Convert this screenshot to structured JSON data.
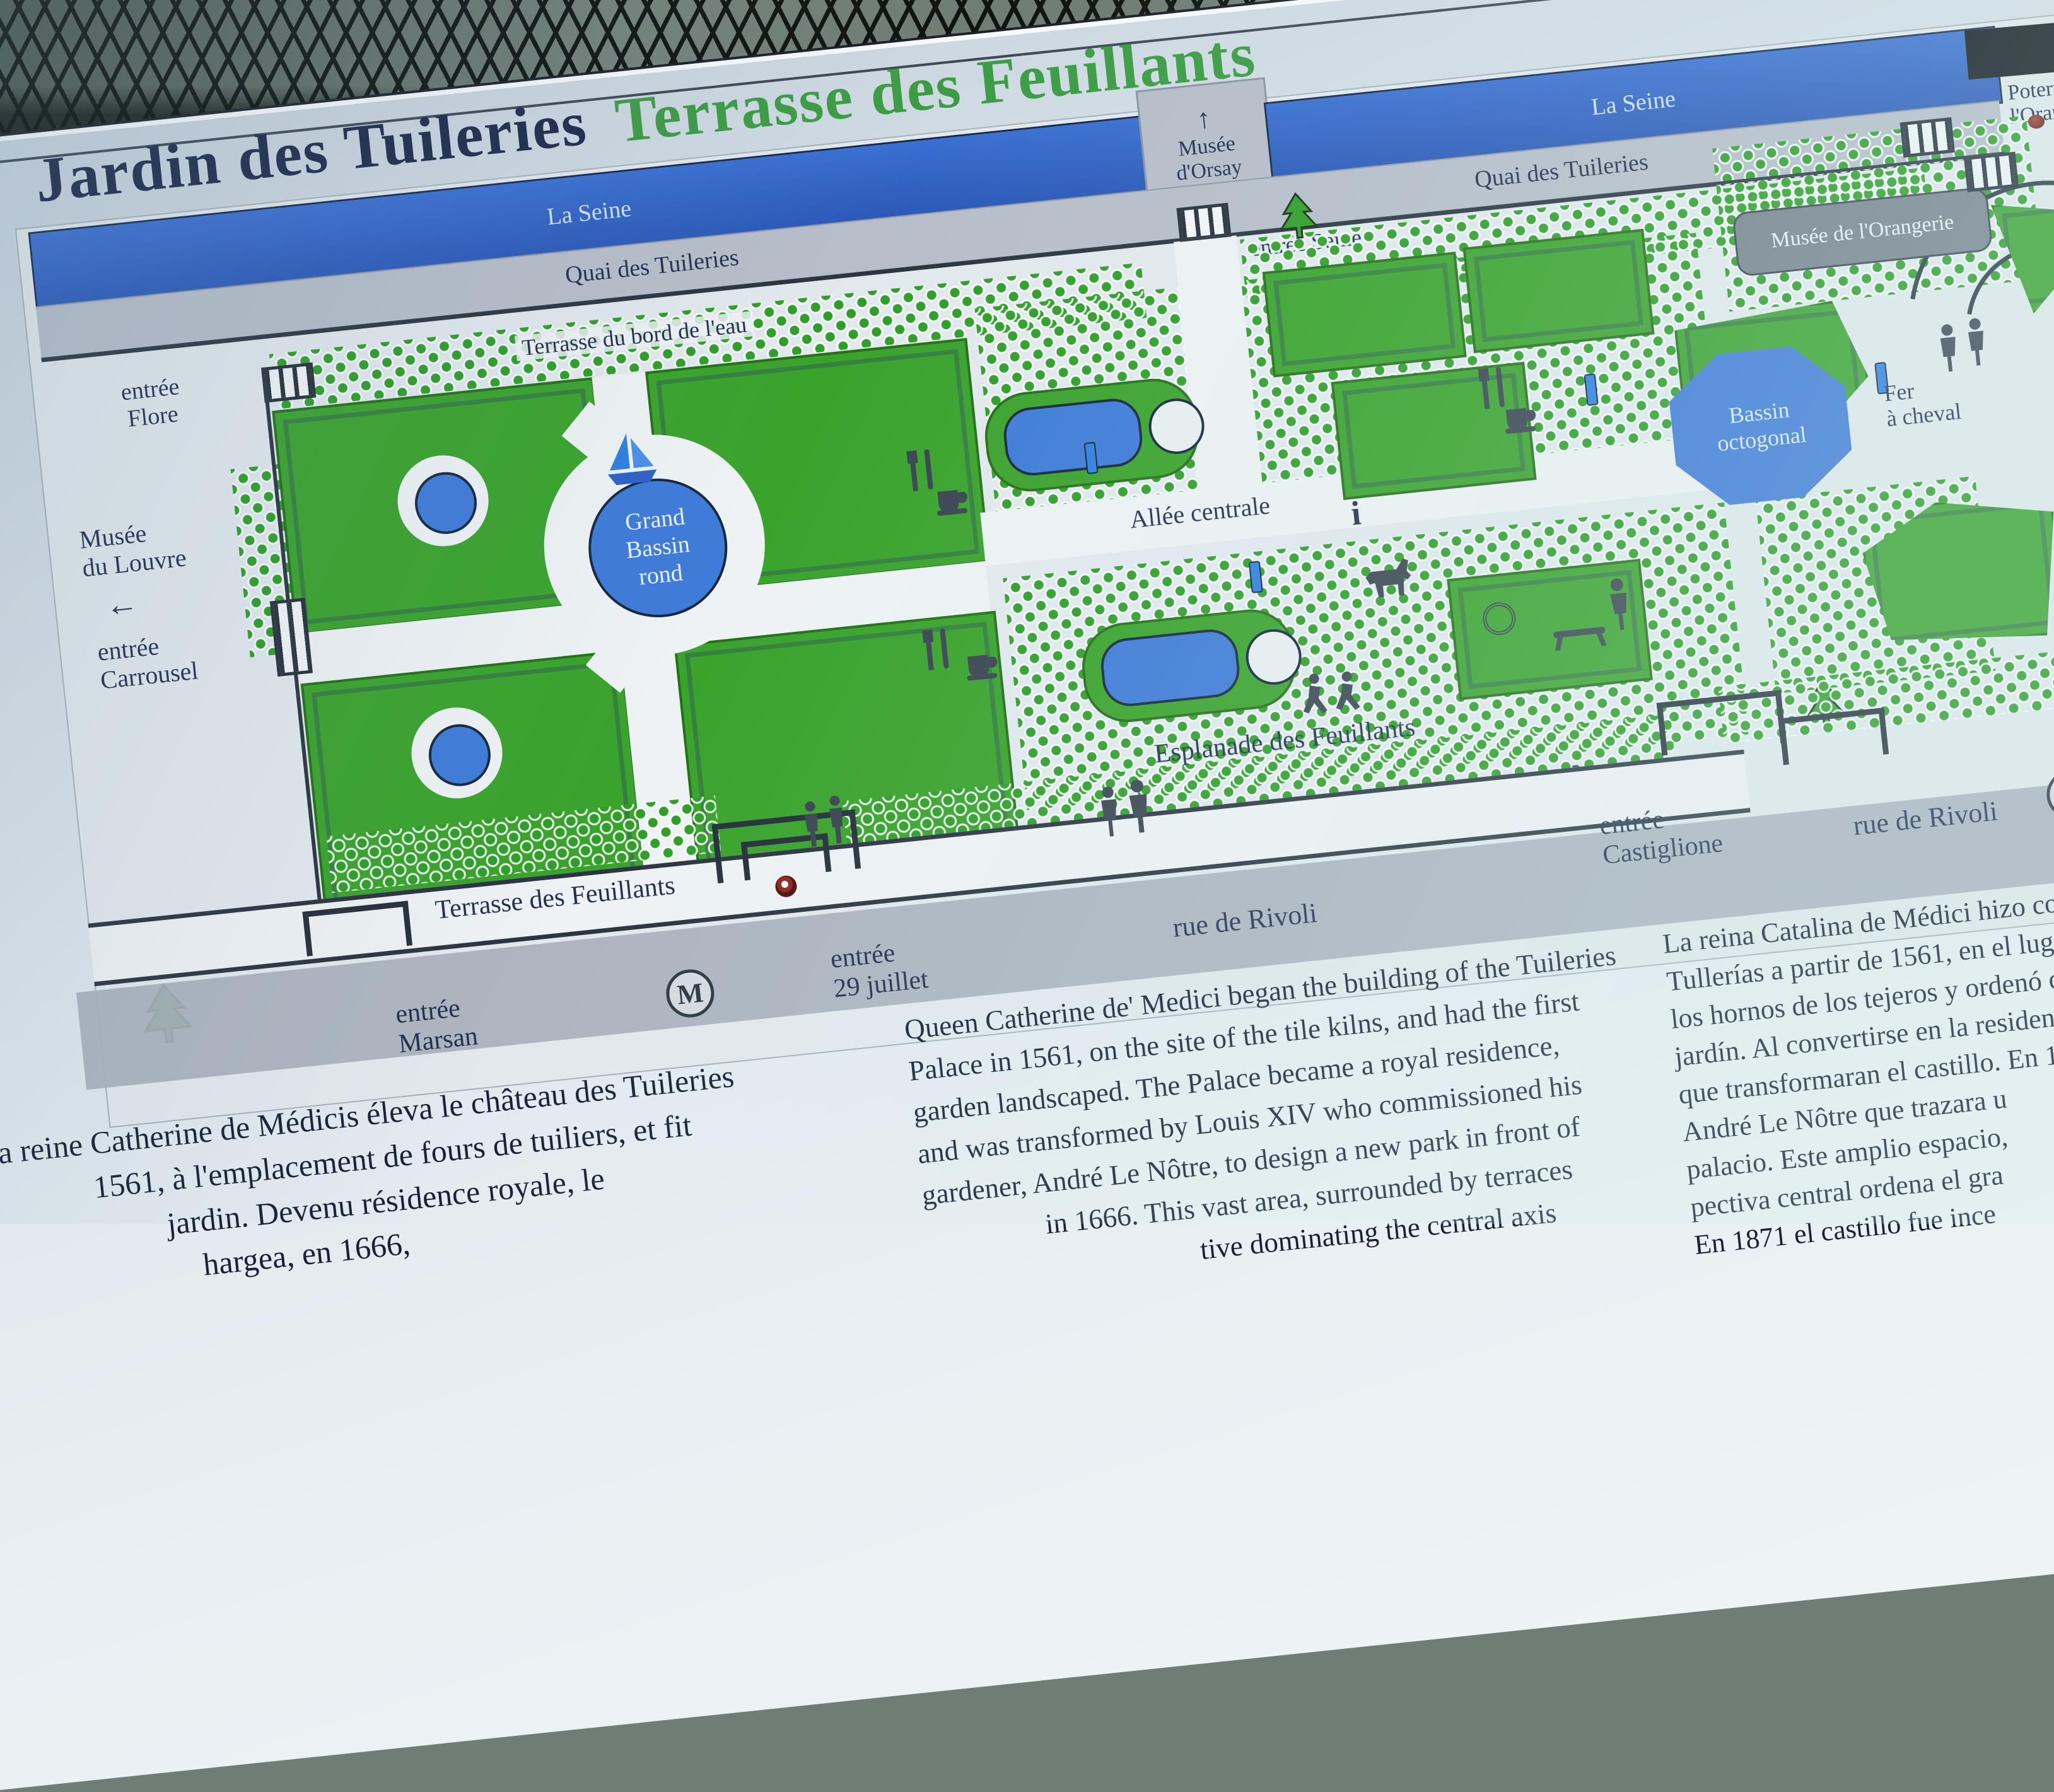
{
  "sign": {
    "title": "Jardin des Tuileries",
    "subtitle": "Terrasse des Feuillants",
    "seine_left": "La Seine",
    "seine_right": "La Seine",
    "quai_left": "Quai des Tuileries",
    "quai_right": "Quai des Tuileries",
    "orsay_arrow": "↑",
    "orsay": "Musée\nd'Orsay",
    "entree_seine": "entrée Seine",
    "entree_poterne": "entrée\nPoterne de\nl'Orangerie",
    "entree_flore": "entrée\nFlore",
    "musee_louvre": "Musée\ndu Louvre",
    "louvre_arrow": "←",
    "entree_carrousel": "entrée\nCarrousel",
    "entree_marsan": "entrée\nMarsan",
    "entree_29juillet": "entrée\n29 juillet",
    "entree_castiglione": "entrée\nCastiglione",
    "terrasse_bord_eau": "Terrasse du bord de l'eau",
    "allee_centrale": "Allée centrale",
    "esplanade": "Esplanade des Feuillants",
    "terrasse_feuillants": "Terrasse des Feuillants",
    "rue_rivoli_left": "rue de Rivoli",
    "rue_rivoli_right": "rue de Rivoli",
    "grand_bassin": "Grand\nBassin\nrond",
    "bassin_octogonal": "Bassin\noctogonal",
    "fer_a_cheval": "Fer\nà cheval",
    "musee_orangerie": "Musée de l'Orangerie",
    "terrasse_orangerie": "Terrasse de l'Orangerie",
    "metro": "M",
    "metro_right": "M",
    "info_i": "i",
    "paragraphs": {
      "french": [
        "a reine Catherine de Médicis éleva le château des Tuileries",
        "1561, à l'emplacement de fours de tuiliers, et fit",
        "jardin. Devenu résidence royale, le",
        "hargea, en 1666,"
      ],
      "english": [
        "Queen Catherine de' Medici began the building of the Tuileries",
        "Palace in 1561, on the site of the tile kilns, and had the first",
        "garden landscaped. The Palace became a royal residence,",
        "and was transformed by Louis XIV who commissioned his",
        "gardener, André Le Nôtre, to design a new park in front of",
        "in 1666. This vast area, surrounded by terraces",
        "tive dominating the central axis"
      ],
      "spanish": [
        "La reina Catalina de Médici hizo constru",
        "Tullerías a partir de 1561, en el lugar d",
        "los hornos de los tejeros y ordenó qu",
        "jardín. Al convertirse en la residenc",
        "que transformaran el castillo. En 1",
        "André Le Nôtre que trazara u",
        "palacio. Este amplio espacio, ",
        "pectiva central ordena el gra",
        "En 1871 el castillo fue ince"
      ]
    }
  },
  "colors": {
    "seine_blue": "#2f62c8",
    "basin_blue": "#3f7bd8",
    "garden_green": "#3aa32c",
    "title_green": "#3c9c44",
    "ink_navy": "#22304d",
    "band_gray": "#b7bec9",
    "rivoli_gray": "#a9b0bc"
  }
}
